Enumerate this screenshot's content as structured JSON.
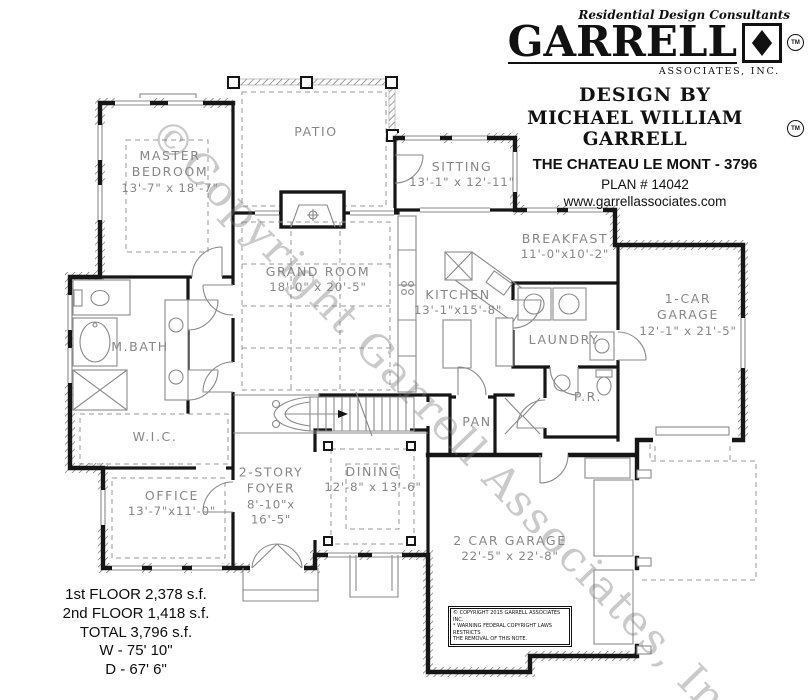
{
  "header": {
    "tagline": "Residential Design Consultants",
    "brand": "GARRELL",
    "brand_tm": "TM",
    "brand_sub": "ASSOCIATES, INC.",
    "design_by": "DESIGN BY",
    "designer": "MICHAEL WILLIAM GARRELL",
    "designer_tm": "TM",
    "plan_name": "THE CHATEAU LE MONT - 3796",
    "plan_number": "PLAN #  14042",
    "website": "www.garrellassociates.com"
  },
  "rooms": {
    "master": {
      "label": "MASTER\nBEDROOM",
      "dims": "13'-7\" x 18'-7\""
    },
    "patio": {
      "label": "PATIO",
      "dims": ""
    },
    "sitting": {
      "label": "SITTING",
      "dims": "13'-1\" x 12'-11\""
    },
    "breakfast": {
      "label": "BREAKFAST",
      "dims": "11'-0\"x10'-2\""
    },
    "garage1": {
      "label": "1-CAR\nGARAGE",
      "dims": "12'-1\" x 21'-5\""
    },
    "grand": {
      "label": "GRAND ROOM",
      "dims": "18'-0\" x 20'-5\""
    },
    "kitchen": {
      "label": "KITCHEN",
      "dims": "13'-1\"x15'-8\""
    },
    "laundry": {
      "label": "LAUNDRY",
      "dims": ""
    },
    "mbath": {
      "label": "M.BATH",
      "dims": ""
    },
    "pr": {
      "label": "P.R.",
      "dims": ""
    },
    "pan": {
      "label": "PAN",
      "dims": ""
    },
    "wic": {
      "label": "W.I.C.",
      "dims": ""
    },
    "office": {
      "label": "OFFICE",
      "dims": "13'-7\"x11'-0\""
    },
    "foyer": {
      "label": "2-STORY\nFOYER",
      "dims": "8'-10\"x\n16'-5\""
    },
    "dining": {
      "label": "DINING",
      "dims": "12'-8\" x 13'-6\""
    },
    "garage2": {
      "label": "2 CAR GARAGE",
      "dims": "22'-5\" x 22'-8\""
    }
  },
  "stats": {
    "floor1": "1st FLOOR  2,378 s.f.",
    "floor2": "2nd FLOOR  1,418 s.f.",
    "total": "TOTAL 3,796 s.f.",
    "width": "W - 75' 10\"",
    "depth": "D - 67' 6\""
  },
  "watermark": "©Copyright Garrell Associates, Inc.",
  "copyright_note": "© COPYRIGHT 2015 GARRELL ASSOCIATES INC.\n* WARNING FEDERAL COPYRIGHT LAWS RESTRICTS\nTHE REMOVAL OF THIS NOTE."
}
